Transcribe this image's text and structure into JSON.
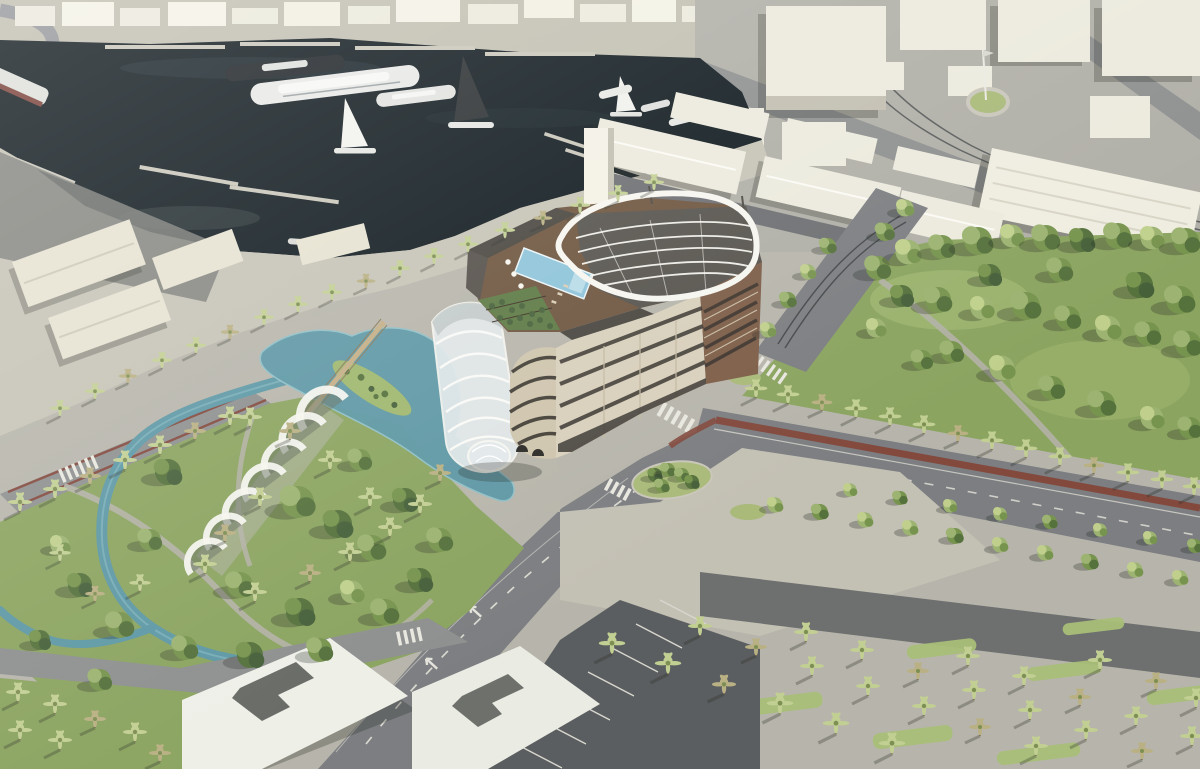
{
  "scene": {
    "type": "3d-architectural-rendering",
    "view": "aerial-oblique",
    "description": "Aerial 3D architectural rendering of a marina waterfront development: a dark-water harbor filled with white yachts and sailboats beside pale massing-model city blocks; a palm-lined quay promenade; a mid-rise hotel block with rooftop pool, roof garden and sculptural white canopy; an attached glass barrel vault and a row of arched glass pavilions in a park with a turquoise lagoon, island, footbridge and winding channel; tree-filled parks, boulevards with red bike lanes, zebra crossings, a parking lot and palm groves.",
    "objects": [
      "harbor-water",
      "finger-piers",
      "yachts",
      "sailboats",
      "far-shore-city-blocks",
      "top-right-city-blocks",
      "tram-tracks",
      "roundabout",
      "flagpole",
      "quay-promenade",
      "quay-warehouses",
      "promenade-palm-row",
      "hotel-building",
      "rooftop-pool",
      "pool-umbrellas",
      "roof-garden",
      "white-roof-canopy",
      "glass-barrel-vault",
      "glass-rotunda",
      "arched-glass-pavilions",
      "park-lagoon",
      "lagoon-island",
      "footbridge",
      "water-channel",
      "left-park-lawn",
      "right-park-trees",
      "avenue-palm-row",
      "boulevard",
      "avenue",
      "red-bike-lanes",
      "zebra-crossings",
      "traffic-islands",
      "parking-lot",
      "palm-grove",
      "chevron-roof-buildings",
      "park-paths"
    ]
  },
  "palette": {
    "water": "#101a1f",
    "waterLight": "#31424a",
    "canal": "#5d98a5",
    "canalLight": "#8fc0c8",
    "pool": "#8ec4da",
    "lawn": "#8ba460",
    "lawnLight": "#a9bf79",
    "lawnDark": "#6d8a4c",
    "treeGreen": "#77944e",
    "treeLight": "#9cb371",
    "treeDark": "#55713c",
    "palmGreen": "#c2cf93",
    "palmDark": "#7e8f53",
    "palmYellow": "#b9b083",
    "paveLight": "#c3c0b4",
    "pave": "#b7b5ab",
    "road": "#8e9090",
    "asphalt": "#7c7e81",
    "roadDark": "#6e706f",
    "block": "#eceadd",
    "blockSide": "#c2bfb1",
    "quay": "#c6c3b6",
    "warehouse": "#e6e2d1",
    "bikeRed": "#83493d",
    "hotelCream": "#d8d0bc",
    "hotelBrick": "#7d5e48",
    "roofDeck": "#6e5640",
    "roofDark": "#4a4640",
    "canopy": "#f6f5ef",
    "glass": "#e3e9ea",
    "parkingDark": "#5b5e60",
    "shadowC": "#23261f"
  }
}
